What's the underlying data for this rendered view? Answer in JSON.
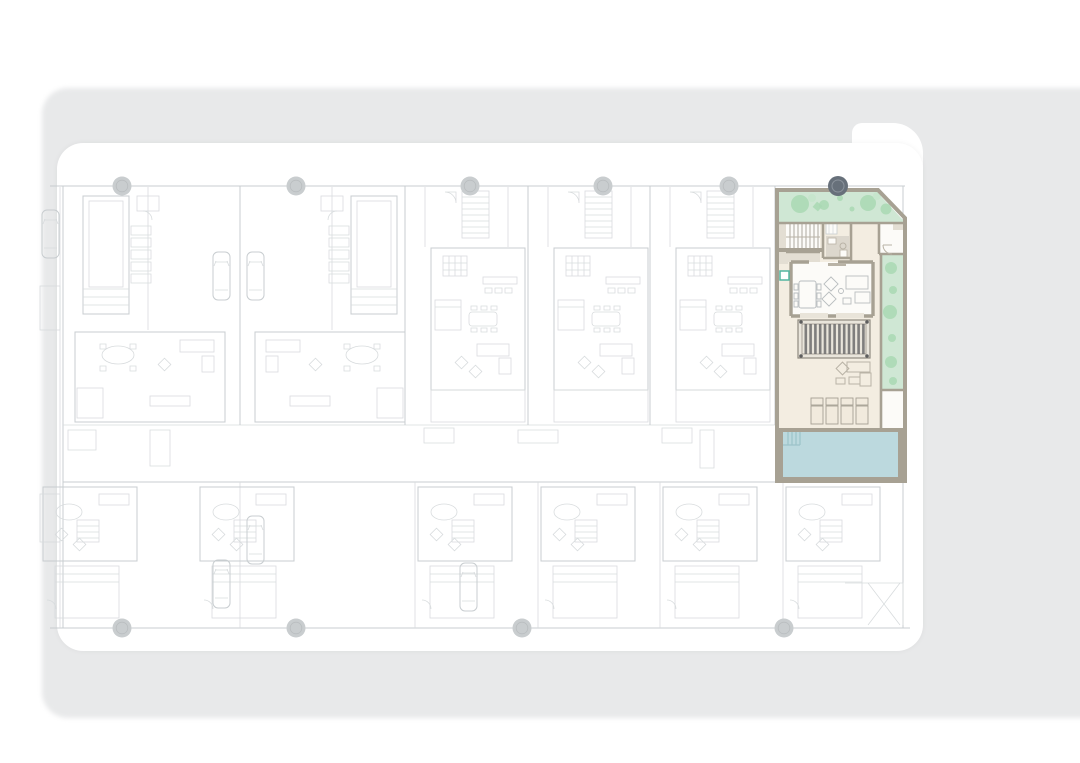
{
  "meta": {
    "description": "Architectural site floor plan of a row of villas; one corner unit highlighted in colour with garden, pergola, terrace and pool",
    "canvas": {
      "width": 1080,
      "height": 763
    }
  },
  "colors": {
    "backdrop": "#e8e9ea",
    "panel": "#ffffff",
    "line": "#d6dadc",
    "line2": "#c6cbce",
    "bubble": "#c9cdcf",
    "bubbleDark": "#67707a",
    "bubbleDarkRing": "#8b939c",
    "wall": "#a7a193",
    "wallLt": "#b9b3a6",
    "garden": "#cfe7d4",
    "tree": "#a9d8b3",
    "treeLight": "#c7e6cd",
    "floor": "#f3ede1",
    "floorTaupe": "#e3ded3",
    "bath": "#dcd7cd",
    "whiteRoom": "#fcfbf8",
    "pool": "#bcd9de",
    "poolLine": "#9cc3c9",
    "pergBg": "#e9e5db",
    "pergLine": "#8f8a80",
    "bar": "#6f6f6f",
    "screw": "#5e5e5e",
    "furn": "#b9bdbf",
    "teal": "#52b5a0",
    "window": "#e9e4d9"
  },
  "site": {
    "grid_bubbles_top": 6,
    "grid_bubbles_bottom": 4,
    "highlighted_bubble_position": "top-right",
    "units_top_row": 6,
    "units_bottom_row": 6,
    "cars_drawn": 6
  },
  "highlight_unit": {
    "location": "top-right corner plot with chamfered corner",
    "garden_trees": 9,
    "side_bushes": 6,
    "pergola_louvres": 13,
    "sun_loungers": 4,
    "pool_steps": 4,
    "stair_treads": 8,
    "has_pool": true,
    "has_corner_chamfer": true
  }
}
